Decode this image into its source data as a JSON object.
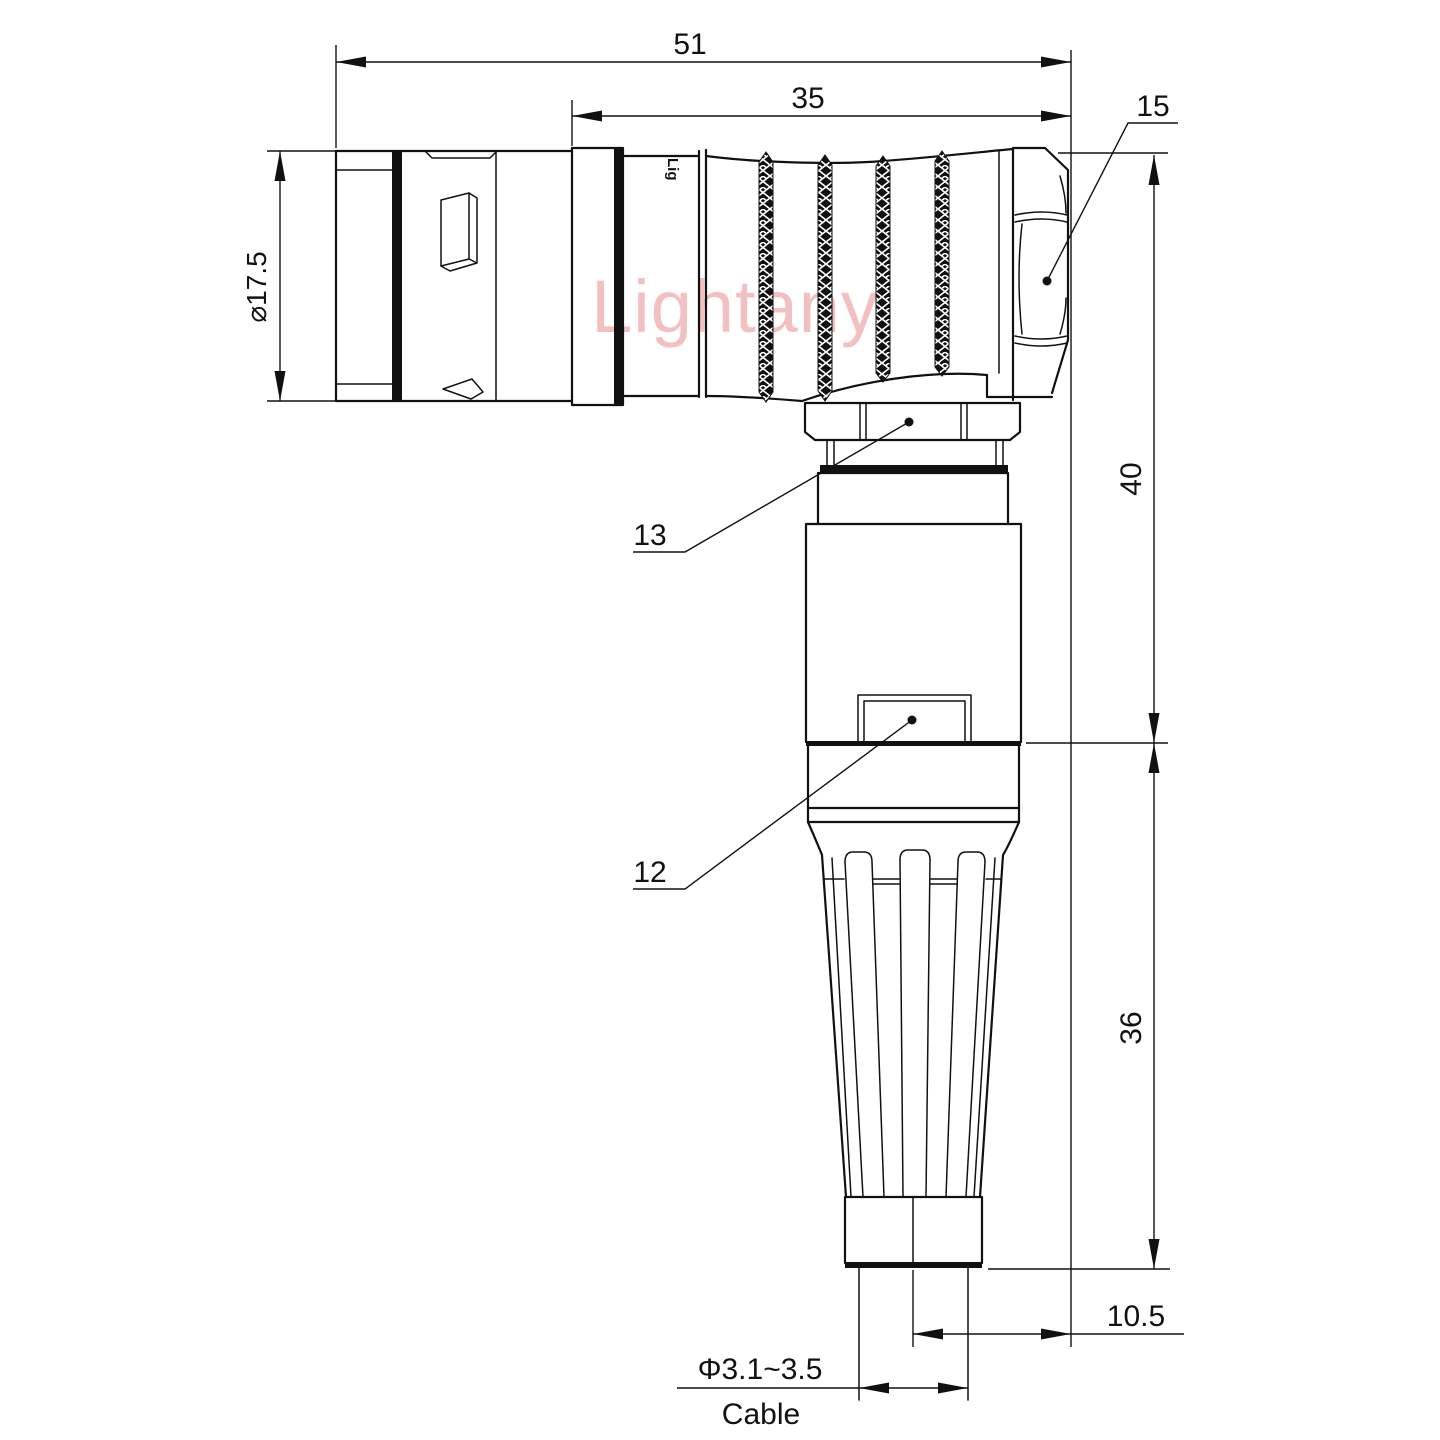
{
  "drawing": {
    "title": "right-angle-connector-dimension-drawing",
    "watermark": {
      "text": "Lightany",
      "color": "#ec9f9f"
    },
    "engraving": {
      "text": "Lig"
    },
    "dimensions": {
      "overall_length": "51",
      "rear_section_length": "35",
      "hex_nut_ref": "15",
      "plug_diameter": "⌀17.5",
      "height_upper": "40",
      "height_lower": "36",
      "cable_offset": "10.5",
      "cable_diameter": "Φ3.1~3.5",
      "cable_label": "Cable",
      "ref_collet_nut": "13",
      "ref_latch": "12"
    },
    "colors": {
      "line": "#111111",
      "background": "#ffffff",
      "watermark_pink": "#ec9f9f"
    }
  }
}
